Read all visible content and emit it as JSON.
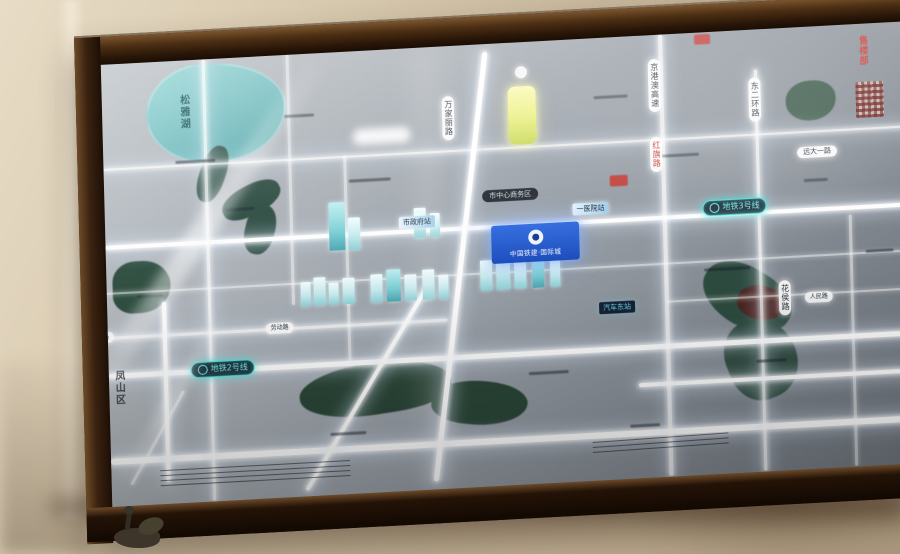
{
  "scene": {
    "type": "photograph-of-backlit-map-display",
    "wall_color": "#d6c8ad",
    "frame_color": "#3a2210",
    "glass_tint": "#9aa1a9"
  },
  "map": {
    "lake_label": "松雅湖",
    "district_label": "凤山区",
    "project_badge": {
      "logo": "ring-logo",
      "name": "中国铁建·国际城"
    },
    "metro_lines": [
      {
        "id": "metro-3",
        "label": "地铁3号线"
      },
      {
        "id": "metro-2",
        "label": "地铁2号线"
      }
    ],
    "stations": {
      "station_a": "市政府站",
      "station_b": "一医院站",
      "station_dark": "汽车东站"
    },
    "poi_dark_pill": "市中心商务区",
    "road_labels_vertical": {
      "a": "万家丽路",
      "b": "京港澳高速",
      "c": "红旗路",
      "d": "东二环路",
      "e": "花侯路"
    },
    "road_labels_horizontal": {
      "right_pill": "远大一路",
      "oval_a": "劳动路",
      "oval_b": "人民路",
      "left_clipped": "湘府路"
    },
    "red_vertical_badge": "售楼部",
    "colors": {
      "road_glow": "#ffffff",
      "metro_accent": "#49e3da",
      "lake": "#7fc7c9",
      "park": "#2c4a3c",
      "badge_blue": "#1e57c8",
      "landmark_yellow": "#e9ef7f",
      "red_badge": "#cf2f26"
    }
  }
}
